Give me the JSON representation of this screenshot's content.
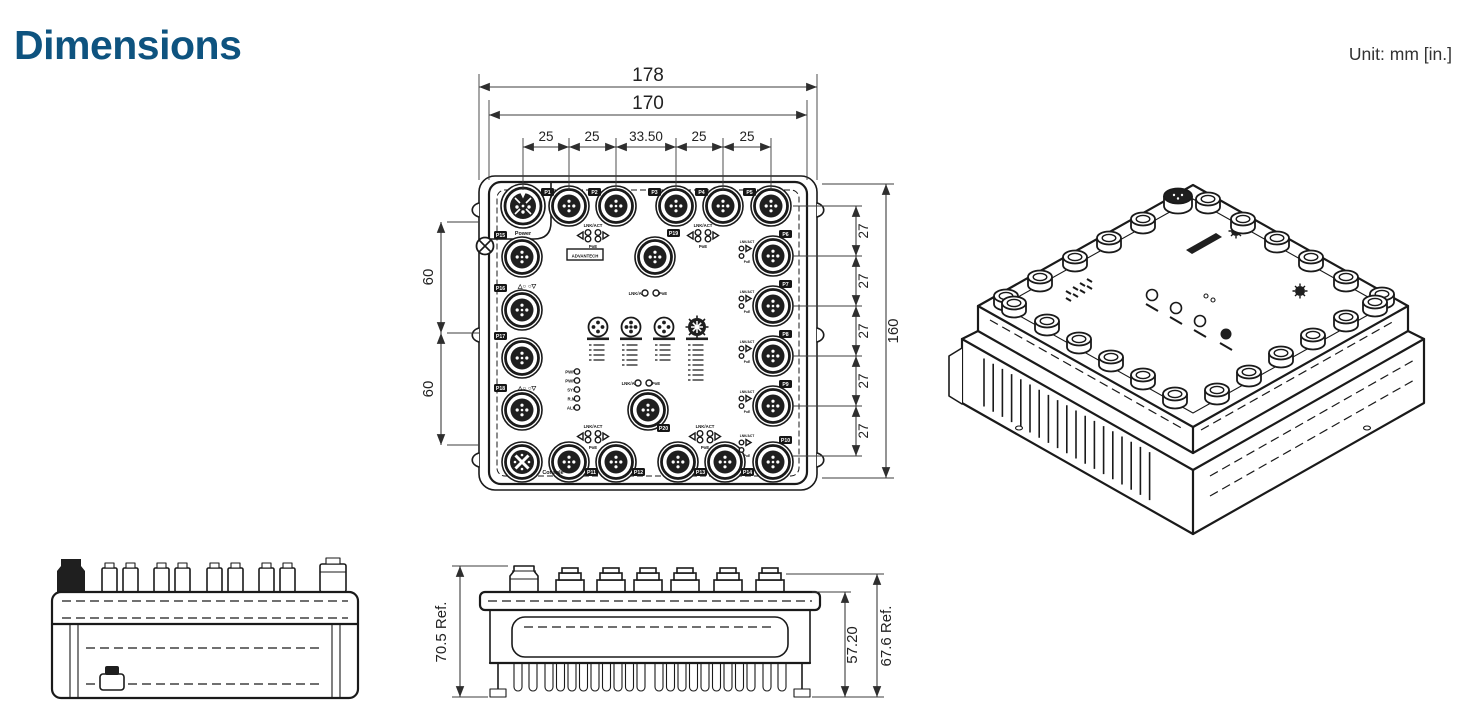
{
  "page": {
    "title": "Dimensions",
    "unit_label": "Unit: mm [in.]",
    "accent_color": "#0e537f",
    "line_color": "#1a1a1a"
  },
  "front_view": {
    "dims": {
      "overall_width": "178",
      "body_width": "170",
      "port_pitch": [
        "25",
        "25",
        "33.50",
        "25",
        "25"
      ],
      "left_pitch": [
        "60",
        "60"
      ],
      "right_pitch": [
        "27",
        "27",
        "27",
        "27",
        "27"
      ],
      "overall_height": "160"
    },
    "labels": {
      "power": "Power",
      "console": "Console",
      "logo": "ADVANTECH",
      "lnk_act": "LNK/ACT",
      "poe": "PoE",
      "dip_marks": "△○ ○▽"
    },
    "led_status": [
      "PWR1",
      "PWR2",
      "SYS",
      "R.M",
      "ALM"
    ],
    "ports": {
      "top": [
        "P1",
        "P2",
        "P3",
        "P4",
        "P5"
      ],
      "right": [
        "P6",
        "P7",
        "P8",
        "P9"
      ],
      "corner": "P10",
      "bottom": [
        "P11",
        "P12",
        "P13",
        "P14"
      ],
      "left": [
        "P15",
        "P16",
        "P17",
        "P18"
      ],
      "center": [
        "P19",
        "P20"
      ]
    }
  },
  "side_view": {
    "dims": {
      "overall_ref": "70.5 Ref.",
      "body_height": "57.20",
      "outer_ref": "67.6 Ref."
    }
  }
}
